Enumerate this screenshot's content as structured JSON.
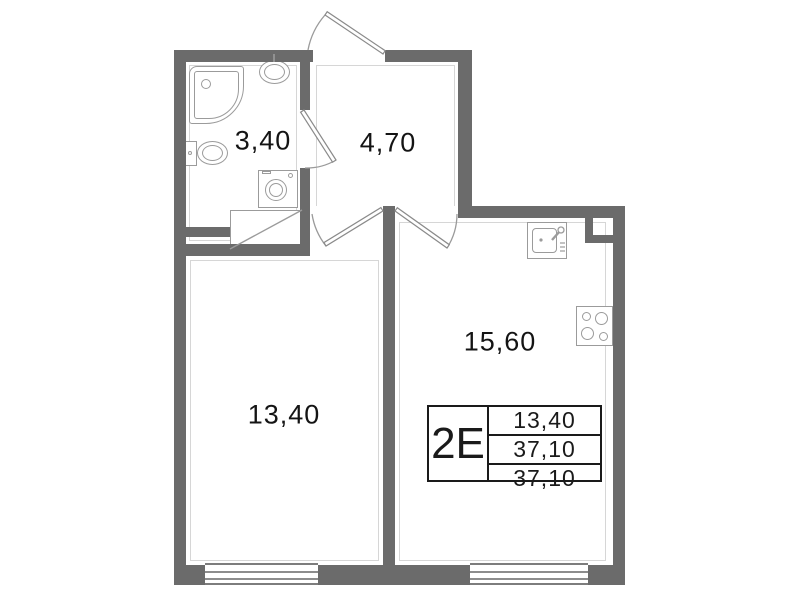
{
  "plan_title": "apartment floor plan",
  "info_table": {
    "type_label": "2Е",
    "rows": [
      "13,40",
      "37,10",
      "37,10"
    ]
  },
  "rooms": {
    "bathroom": {
      "name": "bathroom",
      "area": "3,40"
    },
    "hallway": {
      "name": "hallway",
      "area": "4,70"
    },
    "living_room": {
      "name": "living room",
      "area": "13,40"
    },
    "kitchen": {
      "name": "kitchen",
      "area": "15,60"
    }
  },
  "colors": {
    "wall": "#6b6b6b",
    "fixture_line": "#9b9b9b",
    "door_line": "#8a8a8a",
    "text": "#141414",
    "background": "#ffffff"
  },
  "icons": {
    "bathtub-icon": "css-shape",
    "bathroom-sink-icon": "css-shape",
    "toilet-icon": "css-shape",
    "washing-machine-icon": "css-shape",
    "cabinet-hatch-icon": "rect-with-diagonal",
    "kitchen-sink-icon": "css-shape",
    "stove-icon": "css-shape",
    "vent-shaft-icon": "css-shape",
    "window-icon": "parallel-lines",
    "door-swing-icon": "svg-arc"
  }
}
